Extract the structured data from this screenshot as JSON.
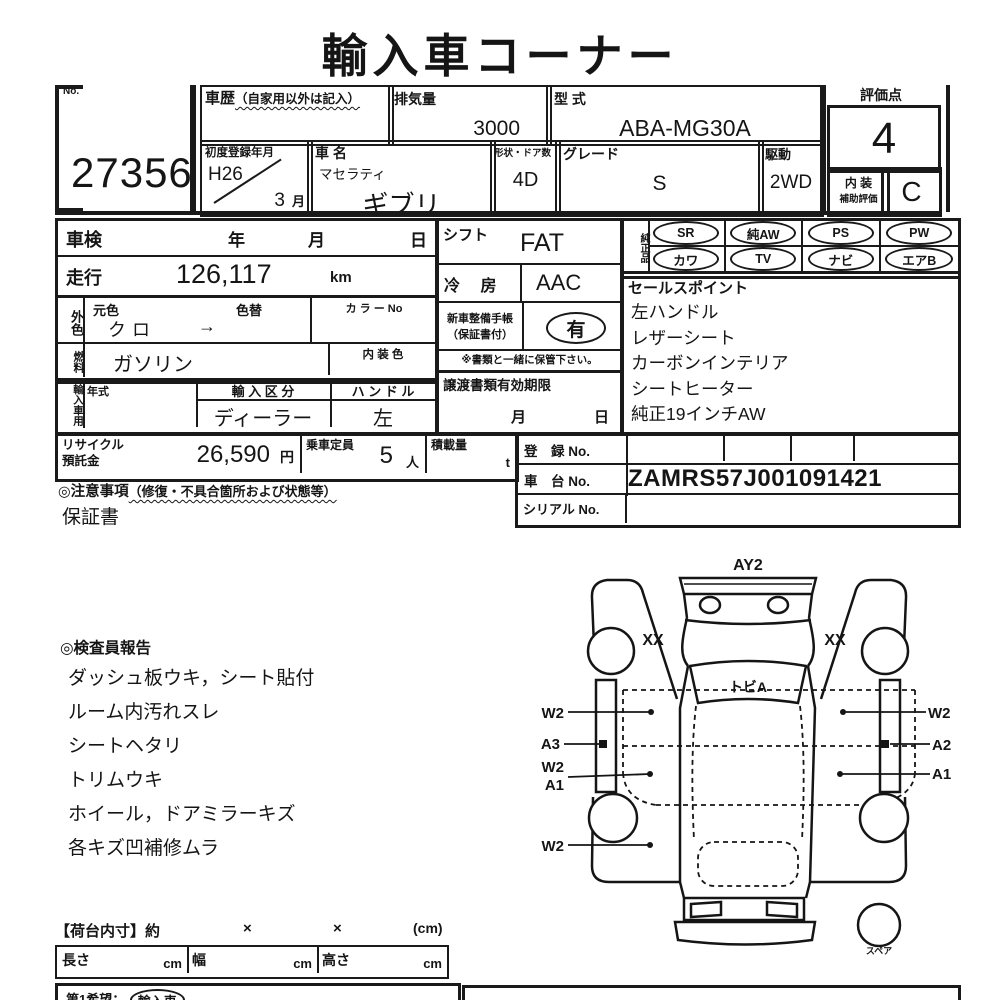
{
  "title": "輸入車コーナー",
  "no_box": {
    "label": "No.",
    "value": "27356"
  },
  "top": {
    "history": {
      "label": "車歴",
      "note": "（自家用以外は記入）"
    },
    "displacement": {
      "label": "排気量",
      "value": "3000"
    },
    "model_code": {
      "label": "型 式",
      "value": "ABA-MG30A"
    },
    "first_reg": {
      "label": "初度登録年月",
      "year": "H26",
      "month": "3",
      "month_unit": "月"
    },
    "car_name": {
      "label": "車 名",
      "maker": "マセラティ",
      "model": "ギブリ"
    },
    "shape_doors": {
      "label": "形状・ドア数",
      "value": "4D"
    },
    "grade": {
      "label": "グレード",
      "value": "S"
    },
    "drive": {
      "label": "駆動",
      "value": "2WD"
    },
    "score": {
      "label": "評価点",
      "value": "4",
      "interior_line1": "内 装",
      "interior_line2": "補助評価",
      "interior_value": "C"
    }
  },
  "inspection": {
    "shaken_label": "車検",
    "year": "年",
    "month": "月",
    "day": "日",
    "mileage_label": "走行",
    "mileage": "126,117",
    "mileage_unit": "km",
    "ext_color_label": "外色",
    "orig_color_label": "元色",
    "orig_color": "クロ",
    "color_change_label": "色替",
    "color_change": "→",
    "color_no_label": "カ ラ ー No",
    "fuel_label": "燃料",
    "fuel": "ガソリン",
    "interior_color_label": "内 装 色",
    "import_label": "輸入車用",
    "year_model_label": "年式",
    "import_class_label": "輸 入 区 分",
    "import_class": "ディーラー",
    "handle_label": "ハ ン ド ル",
    "handle": "左"
  },
  "equipment": {
    "shift_label": "シフト",
    "shift": "FAT",
    "ac_label": "冷 房",
    "ac": "AAC",
    "manual_line1": "新車整備手帳",
    "manual_line2": "（保証書付）",
    "manual_value": "有",
    "keep_note": "※書類と一緒に保管下さい。",
    "transfer_label": "譲渡書類有効期限",
    "transfer_month": "月",
    "transfer_day": "日"
  },
  "genuine": {
    "label": "純正品",
    "items_row1": [
      "SR",
      "純AW",
      "PS",
      "PW"
    ],
    "items_row2": [
      "カワ",
      "TV",
      "ナビ",
      "エアB"
    ]
  },
  "sales_points": {
    "label": "セールスポイント",
    "items": [
      "左ハンドル",
      "レザーシート",
      "カーボンインテリア",
      "シートヒーター",
      "純正19インチAW"
    ]
  },
  "recycle": {
    "label_line1": "リサイクル",
    "label_line2": "預託金",
    "value": "26,590",
    "unit": "円",
    "capacity_label": "乗車定員",
    "capacity": "5",
    "capacity_unit": "人",
    "load_label": "積載量",
    "load_unit": "t"
  },
  "registration": {
    "reg_label": "登　録 No.",
    "chassis_label": "車　台 No.",
    "chassis": "ZAMRS57J001091421",
    "serial_label": "シリアル No."
  },
  "caution": {
    "prefix": "◎注意事項",
    "note": "（修復・不具合箇所および状態等）",
    "warranty": "保証書"
  },
  "inspector_report": {
    "header": "◎検査員報告",
    "items": [
      "ダッシュ板ウキ，シート貼付",
      "ルーム内汚れスレ",
      "シートヘタリ",
      "トリムウキ",
      "ホイール，ドアミラーキズ",
      "各キズ凹補修ムラ"
    ]
  },
  "diagram": {
    "front_label": "AY2",
    "hood_label": "トビA",
    "fender_left": "XX",
    "fender_right": "XX",
    "left_labels": [
      "W2",
      "A3",
      "W2",
      "A1",
      "W2"
    ],
    "right_labels": [
      "W2",
      "A2",
      "A1"
    ],
    "spare_label": "スペア"
  },
  "cargo": {
    "header": "【荷台内寸】約",
    "times1": "×",
    "times2": "×",
    "unit": "(cm)",
    "length_label": "長さ",
    "width_label": "幅",
    "height_label": "高さ",
    "cm1": "cm",
    "cm2": "cm",
    "cm3": "cm"
  },
  "bottom": {
    "wish_label": "第1希望：",
    "wish_value": "輸入車"
  }
}
